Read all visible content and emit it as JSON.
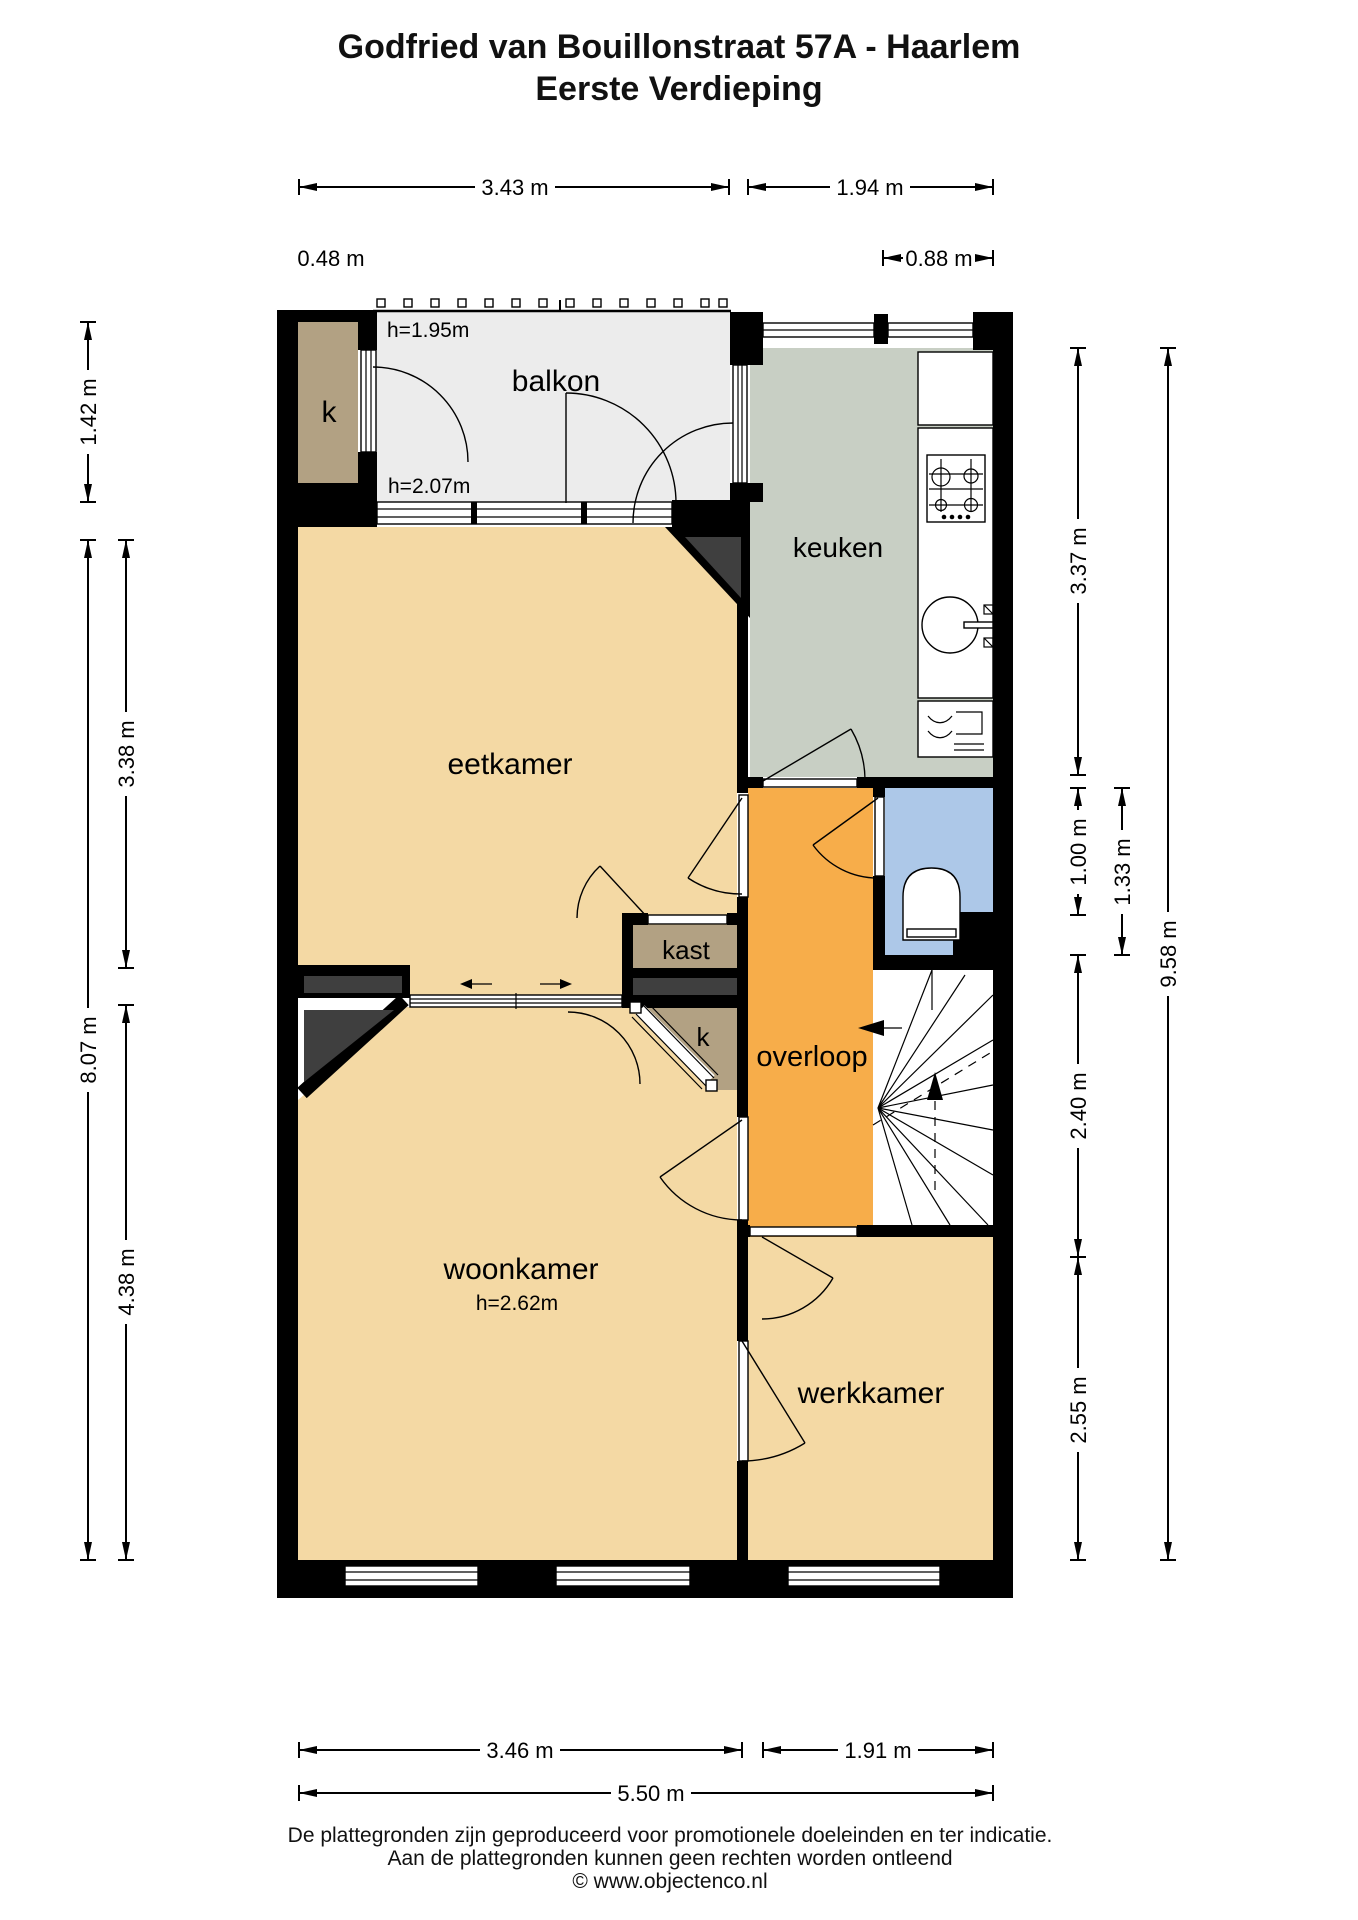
{
  "title": {
    "line1": "Godfried van Bouillonstraat 57A - Haarlem",
    "line2": "Eerste Verdieping"
  },
  "rooms": {
    "balkon": {
      "label": "balkon",
      "ceiling_height_top": "h=1.95m",
      "ceiling_height_bottom": "h=2.07m"
    },
    "keuken": {
      "label": "keuken"
    },
    "eetkamer": {
      "label": "eetkamer"
    },
    "kast": {
      "label": "kast"
    },
    "closet_top": {
      "label": "k"
    },
    "closet_mid": {
      "label": "k"
    },
    "overloop": {
      "label": "overloop"
    },
    "woonkamer": {
      "label": "woonkamer",
      "ceiling_height": "h=2.62m"
    },
    "werkkamer": {
      "label": "werkkamer"
    }
  },
  "dimensions": {
    "top_balkon": "3.43 m",
    "top_keuken": "1.94 m",
    "top_closet": "0.48 m",
    "top_keuken_part": "0.88 m",
    "left_closet": "1.42 m",
    "left_eetkamer": "3.38 m",
    "left_total": "8.07 m",
    "left_woonkamer": "4.38 m",
    "right_keuken": "3.37 m",
    "right_toilet": "1.00 m",
    "right_toilet_total": "1.33 m",
    "right_overloop": "2.40 m",
    "right_werkkamer": "2.55 m",
    "right_total": "9.58 m",
    "bottom_woonkamer": "3.46 m",
    "bottom_werkkamer": "1.91 m",
    "bottom_total": "5.50 m"
  },
  "footer": {
    "line1": "De plattegronden zijn geproduceerd voor promotionele doeleinden en ter indicatie.",
    "line2": "Aan de plattegronden kunnen geen rechten worden ontleend",
    "line3": "© www.objectenco.nl"
  },
  "colors": {
    "wall": "#000000",
    "floor": "#F4D9A4",
    "balcony": "#ECECEC",
    "kitchen": "#C8CFC4",
    "hallway": "#F7AD4A",
    "toilet_room": "#ADC8E8",
    "closet": "#B2A183",
    "chimney": "#3F3F3F",
    "background": "#FFFFFF"
  }
}
